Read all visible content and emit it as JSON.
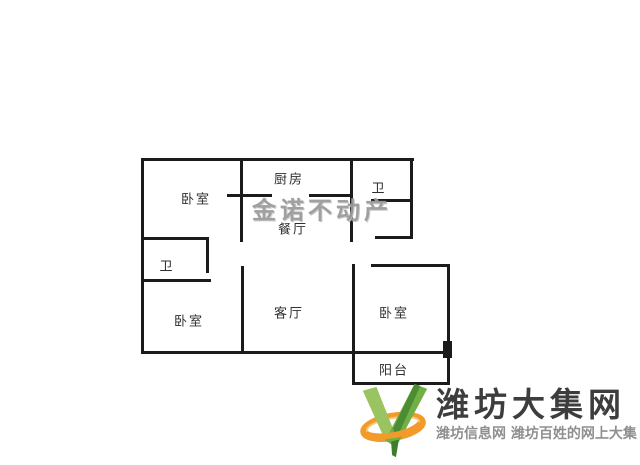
{
  "page": {
    "background": "#ffffff"
  },
  "floorplan": {
    "wall_color": "#1b1b1b",
    "label_color": "#2f2f2f",
    "watermark": {
      "text": "金诺不动产",
      "color": "#9b9b9b",
      "x": 322,
      "y": 208
    },
    "rooms": [
      {
        "id": "bedroom-top-left",
        "label": "卧室",
        "x": 196,
        "y": 198
      },
      {
        "id": "kitchen",
        "label": "厨房",
        "x": 289,
        "y": 178
      },
      {
        "id": "bathroom-top",
        "label": "卫",
        "x": 379,
        "y": 187
      },
      {
        "id": "dining-room",
        "label": "餐厅",
        "x": 293,
        "y": 228
      },
      {
        "id": "bathroom-left",
        "label": "卫",
        "x": 167,
        "y": 265
      },
      {
        "id": "bedroom-bottom-left",
        "label": "卧室",
        "x": 189,
        "y": 320
      },
      {
        "id": "living-room",
        "label": "客厅",
        "x": 289,
        "y": 312
      },
      {
        "id": "bedroom-right",
        "label": "卧室",
        "x": 394,
        "y": 312
      },
      {
        "id": "balcony",
        "label": "阳台",
        "x": 394,
        "y": 369
      }
    ],
    "walls": [
      {
        "name": "outer-top",
        "x": 141,
        "y": 158,
        "w": 273,
        "h": 3
      },
      {
        "name": "outer-left",
        "x": 141,
        "y": 158,
        "w": 3,
        "h": 196
      },
      {
        "name": "outer-bottom",
        "x": 141,
        "y": 351,
        "w": 310,
        "h": 3
      },
      {
        "name": "outer-right-upper",
        "x": 410,
        "y": 158,
        "w": 3,
        "h": 81
      },
      {
        "name": "entry-bottom",
        "x": 375,
        "y": 236,
        "w": 38,
        "h": 3
      },
      {
        "name": "dining-left-upper",
        "x": 240,
        "y": 158,
        "w": 3,
        "h": 84
      },
      {
        "name": "kitchen-bottom-left",
        "x": 240,
        "y": 194,
        "w": 32,
        "h": 3
      },
      {
        "name": "kitchen-bottom-right",
        "x": 309,
        "y": 194,
        "w": 43,
        "h": 3
      },
      {
        "name": "bedroom1-door-tick",
        "x": 227,
        "y": 194,
        "w": 13,
        "h": 3
      },
      {
        "name": "kitchen-right",
        "x": 350,
        "y": 158,
        "w": 3,
        "h": 84
      },
      {
        "name": "bath-top-bottom",
        "x": 371,
        "y": 199,
        "w": 42,
        "h": 3
      },
      {
        "name": "bath-left-top",
        "x": 141,
        "y": 237,
        "w": 68,
        "h": 3
      },
      {
        "name": "bath-left-right",
        "x": 206,
        "y": 237,
        "w": 3,
        "h": 36
      },
      {
        "name": "bath-left-bottom",
        "x": 141,
        "y": 279,
        "w": 70,
        "h": 3
      },
      {
        "name": "living-left",
        "x": 241,
        "y": 266,
        "w": 3,
        "h": 88
      },
      {
        "name": "living-right",
        "x": 352,
        "y": 264,
        "w": 3,
        "h": 121
      },
      {
        "name": "bedroom-right-top",
        "x": 371,
        "y": 264,
        "w": 79,
        "h": 3
      },
      {
        "name": "bedroom-right-right",
        "x": 447,
        "y": 264,
        "w": 3,
        "h": 121
      },
      {
        "name": "balcony-bottom",
        "x": 352,
        "y": 382,
        "w": 98,
        "h": 3
      },
      {
        "name": "balcony-door-block",
        "x": 443,
        "y": 341,
        "w": 9,
        "h": 17
      }
    ]
  },
  "logo": {
    "title": "潍坊大集网",
    "tagline": "潍坊信息网 潍坊百姓的网上大集",
    "title_color": "#3d3d3d",
    "tagline_color": "#8f8f8f",
    "icon_colors": {
      "green_light": "#9ac45f",
      "green_mid": "#72af45",
      "green_dark": "#4c8d33",
      "orange": "#f39b2a",
      "orange_light": "#fbc97c"
    }
  }
}
